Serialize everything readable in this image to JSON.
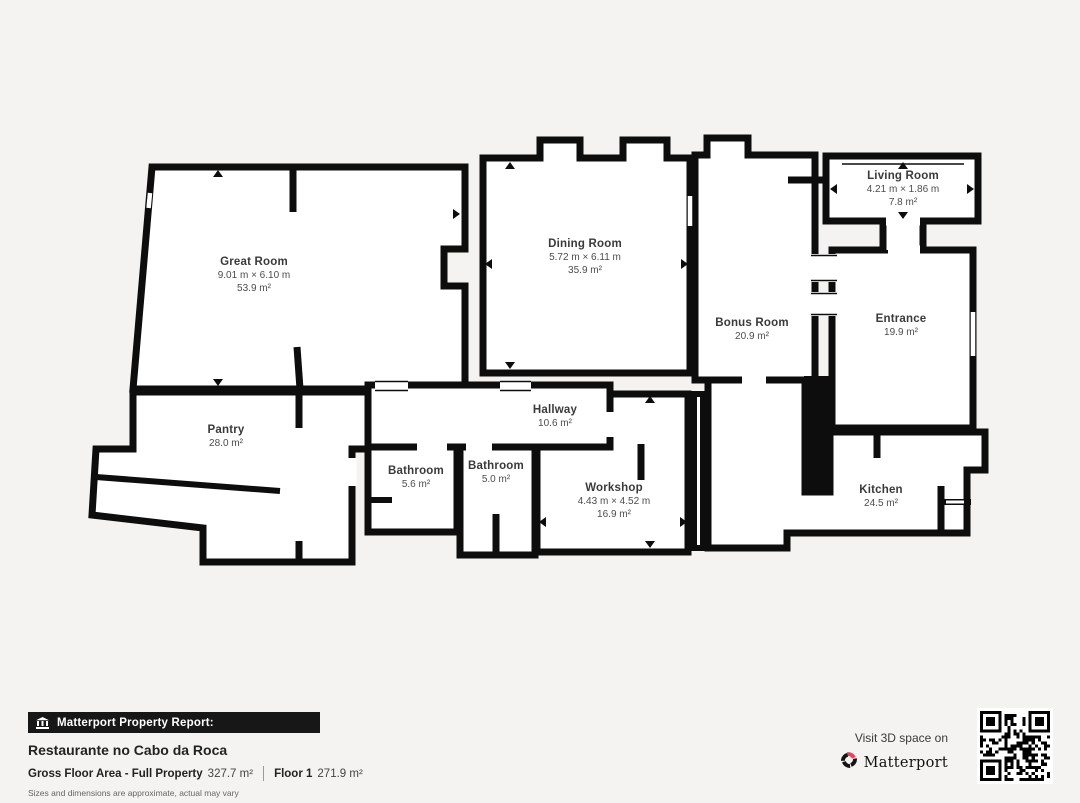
{
  "floorplan": {
    "rooms": [
      {
        "id": "great-room",
        "name": "Great Room",
        "dims": "9.01 m × 6.10 m",
        "area": "53.9 m²"
      },
      {
        "id": "dining-room",
        "name": "Dining Room",
        "dims": "5.72 m × 6.11 m",
        "area": "35.9 m²"
      },
      {
        "id": "living-room",
        "name": "Living Room",
        "dims": "4.21 m × 1.86 m",
        "area": "7.8 m²"
      },
      {
        "id": "bonus-room",
        "name": "Bonus Room",
        "area": "20.9 m²"
      },
      {
        "id": "entrance",
        "name": "Entrance",
        "area": "19.9 m²"
      },
      {
        "id": "pantry",
        "name": "Pantry",
        "area": "28.0 m²"
      },
      {
        "id": "hallway",
        "name": "Hallway",
        "area": "10.6 m²"
      },
      {
        "id": "bathroom-1",
        "name": "Bathroom",
        "area": "5.6 m²"
      },
      {
        "id": "bathroom-2",
        "name": "Bathroom",
        "area": "5.0 m²"
      },
      {
        "id": "workshop",
        "name": "Workshop",
        "dims": "4.43 m × 4.52 m",
        "area": "16.9 m²"
      },
      {
        "id": "kitchen",
        "name": "Kitchen",
        "area": "24.5 m²"
      }
    ]
  },
  "footer": {
    "banner_label": "Matterport Property Report:",
    "property_name": "Restaurante no Cabo da Roca",
    "gross_area_label": "Gross Floor Area - Full Property",
    "gross_area_value": "327.7 m²",
    "floor_label": "Floor 1",
    "floor_value": "271.9 m²",
    "disclaimer": "Sizes and dimensions are approximate, actual may vary"
  },
  "cta": {
    "visit_text": "Visit 3D space on",
    "brand_name": "Matterport"
  },
  "colors": {
    "wall": "#0d0d0d",
    "background": "#f4f3f1",
    "brand_red": "#ee3d5f"
  }
}
